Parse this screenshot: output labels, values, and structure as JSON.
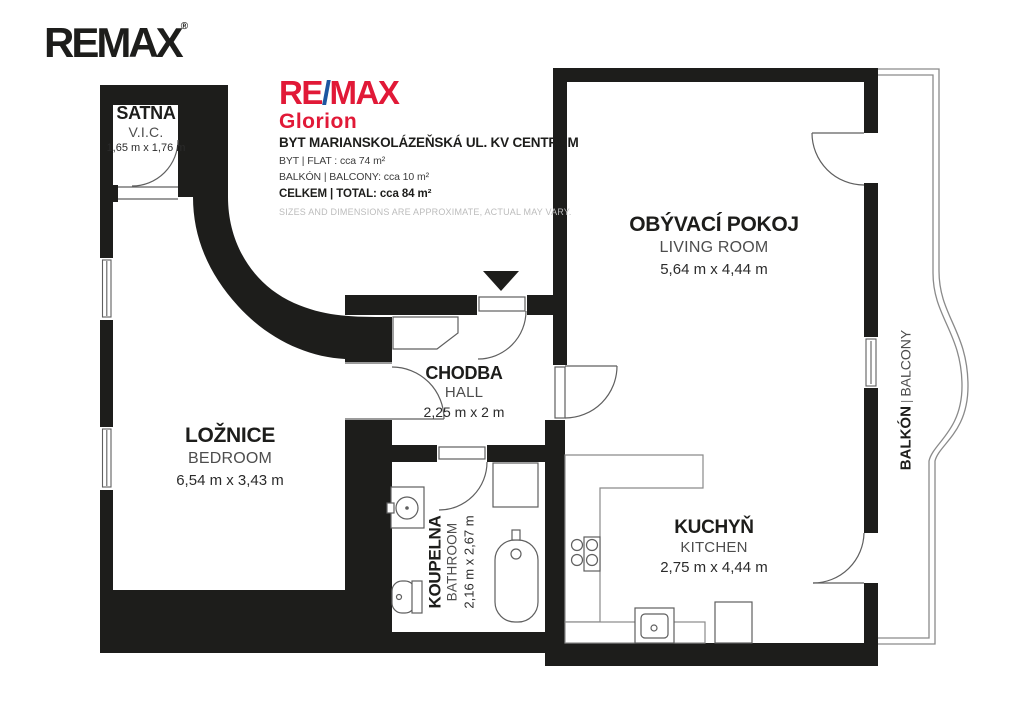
{
  "branding": {
    "remax_logo_text": "REMAX",
    "remax_logo_mark": "®",
    "office": {
      "re": "RE",
      "slash": "/",
      "max": "MAX",
      "name": "Glorion"
    }
  },
  "header": {
    "title": "BYT MARIANSKOLÁZEŇSKÁ UL. KV CENTRUM",
    "flat": "BYT | FLAT : cca 74 m²",
    "balcony": "BALKÓN | BALCONY: cca 10 m²",
    "total": "CELKEM | TOTAL: cca 84 m²",
    "disclaimer": "SIZES AND DIMENSIONS ARE APPROXIMATE, ACTUAL MAY VARY."
  },
  "rooms": {
    "satna": {
      "name": "ŠATNA",
      "name_en": "V.I.C.",
      "dims": "1,65 m x 1,76 m"
    },
    "loznice": {
      "name": "LOŽNICE",
      "name_en": "BEDROOM",
      "dims": "6,54 m x 3,43 m"
    },
    "chodba": {
      "name": "CHODBA",
      "name_en": "HALL",
      "dims": "2,25 m x 2 m"
    },
    "obyvaci_pokoj": {
      "name": "OBÝVACÍ POKOJ",
      "name_en": "LIVING ROOM",
      "dims": "5,64 m x 4,44 m"
    },
    "kuchyn": {
      "name": "KUCHYŇ",
      "name_en": "KITCHEN",
      "dims": "2,75 m x 4,44 m"
    },
    "koupelna": {
      "name": "KOUPELNA",
      "name_en": "BATHROOM",
      "dims": "2,16 m x 2,67 m"
    },
    "balkon": {
      "name": "BALKÓN",
      "separator": "|",
      "name_en": "BALCONY"
    }
  },
  "colors": {
    "wall": "#1d1d1b",
    "remax_red": "#e11937",
    "remax_blue": "#1c56a0",
    "fixture_stroke": "#5f5f5f",
    "disclaimer_gray": "#bcbcbc"
  }
}
